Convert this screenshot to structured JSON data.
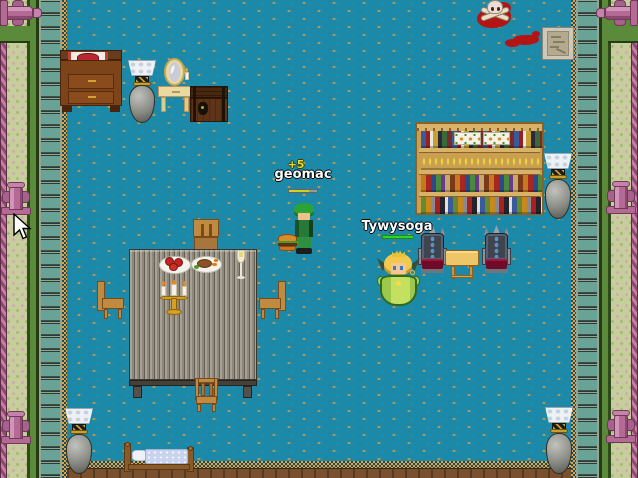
{
  "window": {
    "title": "2D RPG room scene",
    "width": 638,
    "height": 478
  },
  "players": [
    {
      "name": "geomac",
      "damage_text": "+5",
      "hp_percent": 72,
      "hp_fill_color": "#d8d01e",
      "hp_track_color": "#9a9a9a",
      "ground_item": "hamburger"
    },
    {
      "name": "Tywysoga",
      "hp_percent": 100,
      "hp_fill_color": "#35d225",
      "hp_track_color": "#35d225"
    }
  ],
  "scene": {
    "objects": [
      "dresser-with-runner",
      "stone-lamp-vase-top-left",
      "vanity-mirror-table",
      "wooden-chest",
      "skull-and-crossbones",
      "blood-smear",
      "stone-tablet",
      "bookshelf",
      "stone-lamp-vase-right",
      "throne-left",
      "throne-right",
      "side-table",
      "dining-table",
      "chair-top",
      "chair-left",
      "chair-right",
      "chair-bottom",
      "plate-of-apples",
      "roast-dinner-plate",
      "champagne-flute",
      "candelabra",
      "bed",
      "stone-lamp-vase-bottom-left",
      "stone-lamp-vase-bottom-right",
      "mouse-cursor"
    ],
    "colors": {
      "floor": "#1d89a9",
      "floor_dot": "#d99a3b",
      "wall_tile_teal": "#68a395",
      "wall_light_green": "#c6cf9b",
      "statue_pink": "#b56a96",
      "gold_trim": "#e2a33c",
      "blood_red": "#b51414",
      "table_gray": "#8e887c",
      "wood": "#c08a40"
    }
  }
}
